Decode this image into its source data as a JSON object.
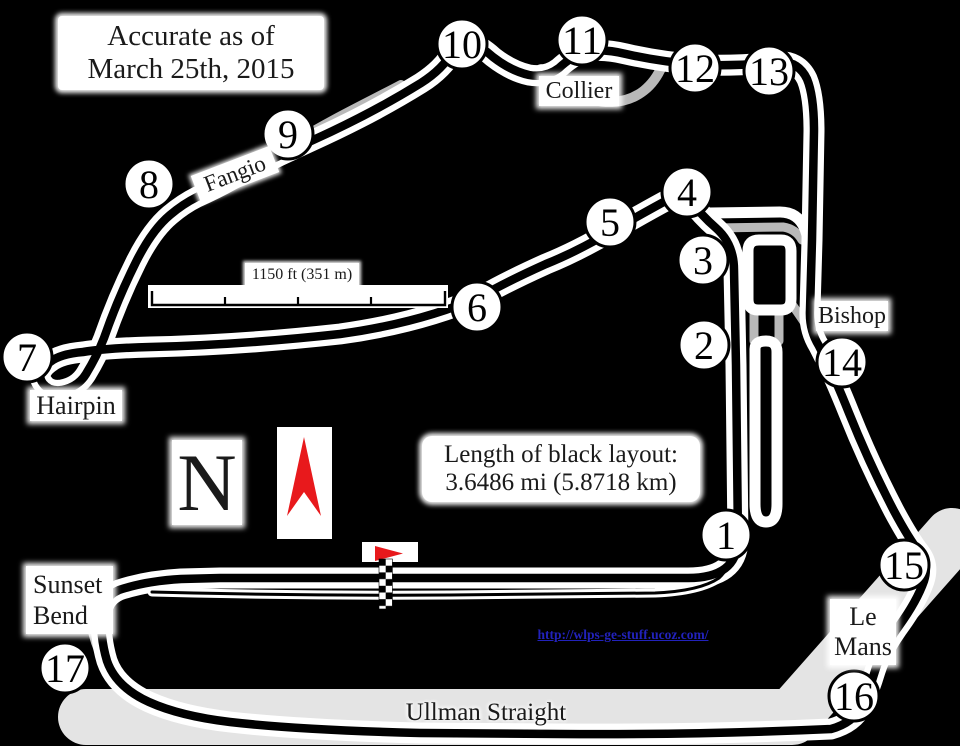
{
  "map": {
    "note_line1": "Accurate as of",
    "note_line2": "March 25th, 2015",
    "length_line1": "Length of black layout:",
    "length_line2": "3.6486 mi (5.8718 km)",
    "scale_label": "1150 ft (351 m)",
    "compass_letter": "N",
    "url_text": "http://wlps-ge-stuff.ucoz.com/"
  },
  "corner_labels": {
    "collier": "Collier",
    "fangio": "Fangio",
    "bishop": "Bishop",
    "hairpin": "Hairpin",
    "sunset_line1": "Sunset",
    "sunset_line2": "Bend",
    "lemans_line1": "Le",
    "lemans_line2": "Mans",
    "ullman": "Ullman Straight"
  },
  "corners": [
    {
      "label": "1",
      "x": 726,
      "y": 535
    },
    {
      "label": "2",
      "x": 704,
      "y": 345
    },
    {
      "label": "3",
      "x": 703,
      "y": 260
    },
    {
      "label": "4",
      "x": 687,
      "y": 192
    },
    {
      "label": "5",
      "x": 610,
      "y": 222
    },
    {
      "label": "6",
      "x": 477,
      "y": 307
    },
    {
      "label": "7",
      "x": 27,
      "y": 357
    },
    {
      "label": "8",
      "x": 149,
      "y": 184
    },
    {
      "label": "9",
      "x": 288,
      "y": 134
    },
    {
      "label": "10",
      "x": 462,
      "y": 44
    },
    {
      "label": "11",
      "x": 582,
      "y": 40
    },
    {
      "label": "12",
      "x": 695,
      "y": 68
    },
    {
      "label": "13",
      "x": 769,
      "y": 71
    },
    {
      "label": "14",
      "x": 842,
      "y": 362
    },
    {
      "label": "15",
      "x": 904,
      "y": 565
    },
    {
      "label": "16",
      "x": 854,
      "y": 696
    },
    {
      "label": "17",
      "x": 65,
      "y": 668
    }
  ],
  "colors": {
    "background": "#000000",
    "track": "#000000",
    "casing": "#ffffff",
    "alt_road": "#b9b9b9",
    "runway": "#e4e4e4",
    "flag_red": "#e8191c",
    "link_blue": "#2222bb"
  }
}
